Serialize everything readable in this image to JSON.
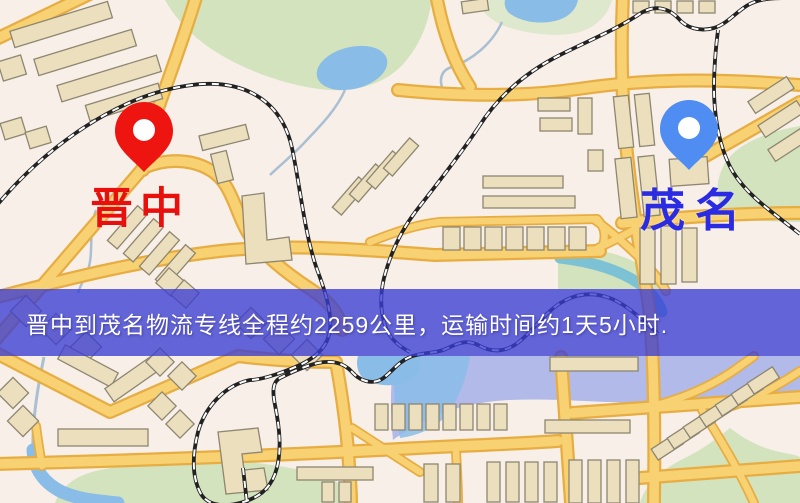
{
  "map": {
    "origin_marker": {
      "label": "晋中",
      "pin_color": "#ee1410",
      "label_color": "#e8100c"
    },
    "destination_marker": {
      "label": "茂名",
      "pin_color": "#4f8df2",
      "label_color": "#2b2be2"
    },
    "banner": {
      "text": "晋中到茂名物流专线全程约2259公里，运输时间约1天5小时.",
      "bg": "rgba(58,60,210,0.78)",
      "text_color": "#ffffff"
    },
    "palette": {
      "background": "#f7efe8",
      "road": "#f8d272",
      "road_casing": "#e7ad42",
      "building": "#ebdfbe",
      "building_stroke": "#8e8670",
      "park": "#d3e3bd",
      "park_pale": "#dde8cc",
      "water": "#8abce8",
      "water_wash": "#a9b4e8",
      "river_teal": "#7cc2d4",
      "stream": "#aac0d2",
      "railway": "#222222",
      "railway_dash": "#ffffff",
      "pin_hole": "#ffffff"
    }
  }
}
